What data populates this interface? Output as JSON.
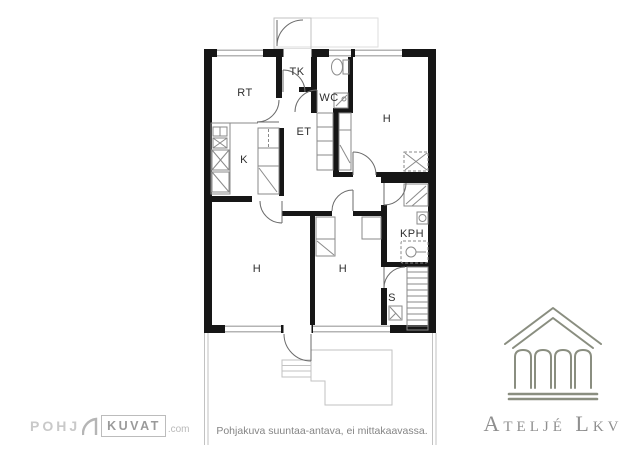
{
  "plan": {
    "caption": "Pohjakuva suuntaa-antava, ei mittakaavassa.",
    "rooms": [
      {
        "id": "rt",
        "label": "RT"
      },
      {
        "id": "tk",
        "label": "TK"
      },
      {
        "id": "wc",
        "label": "WC"
      },
      {
        "id": "et",
        "label": "ET"
      },
      {
        "id": "k",
        "label": "K"
      },
      {
        "id": "h1",
        "label": "H"
      },
      {
        "id": "h2",
        "label": "H"
      },
      {
        "id": "h3",
        "label": "H"
      },
      {
        "id": "kph",
        "label": "KPH"
      },
      {
        "id": "s",
        "label": "S"
      }
    ]
  },
  "branding": {
    "pohjakuvat_part1": "POHJ",
    "pohjakuvat_part2": "KUVAT",
    "pohjakuvat_suffix": ".com",
    "agency_name": "Ateljé Lkv"
  },
  "colors": {
    "wall": "#161616",
    "fixture_line": "#8a8a8a",
    "exterior_line": "#c2c2c2",
    "label_text": "#2e2e2e",
    "caption_text": "#858585",
    "logo_gray": "#bcbcbc",
    "agency_green": "#8a8e80",
    "agency_text": "#8f8f8f"
  }
}
